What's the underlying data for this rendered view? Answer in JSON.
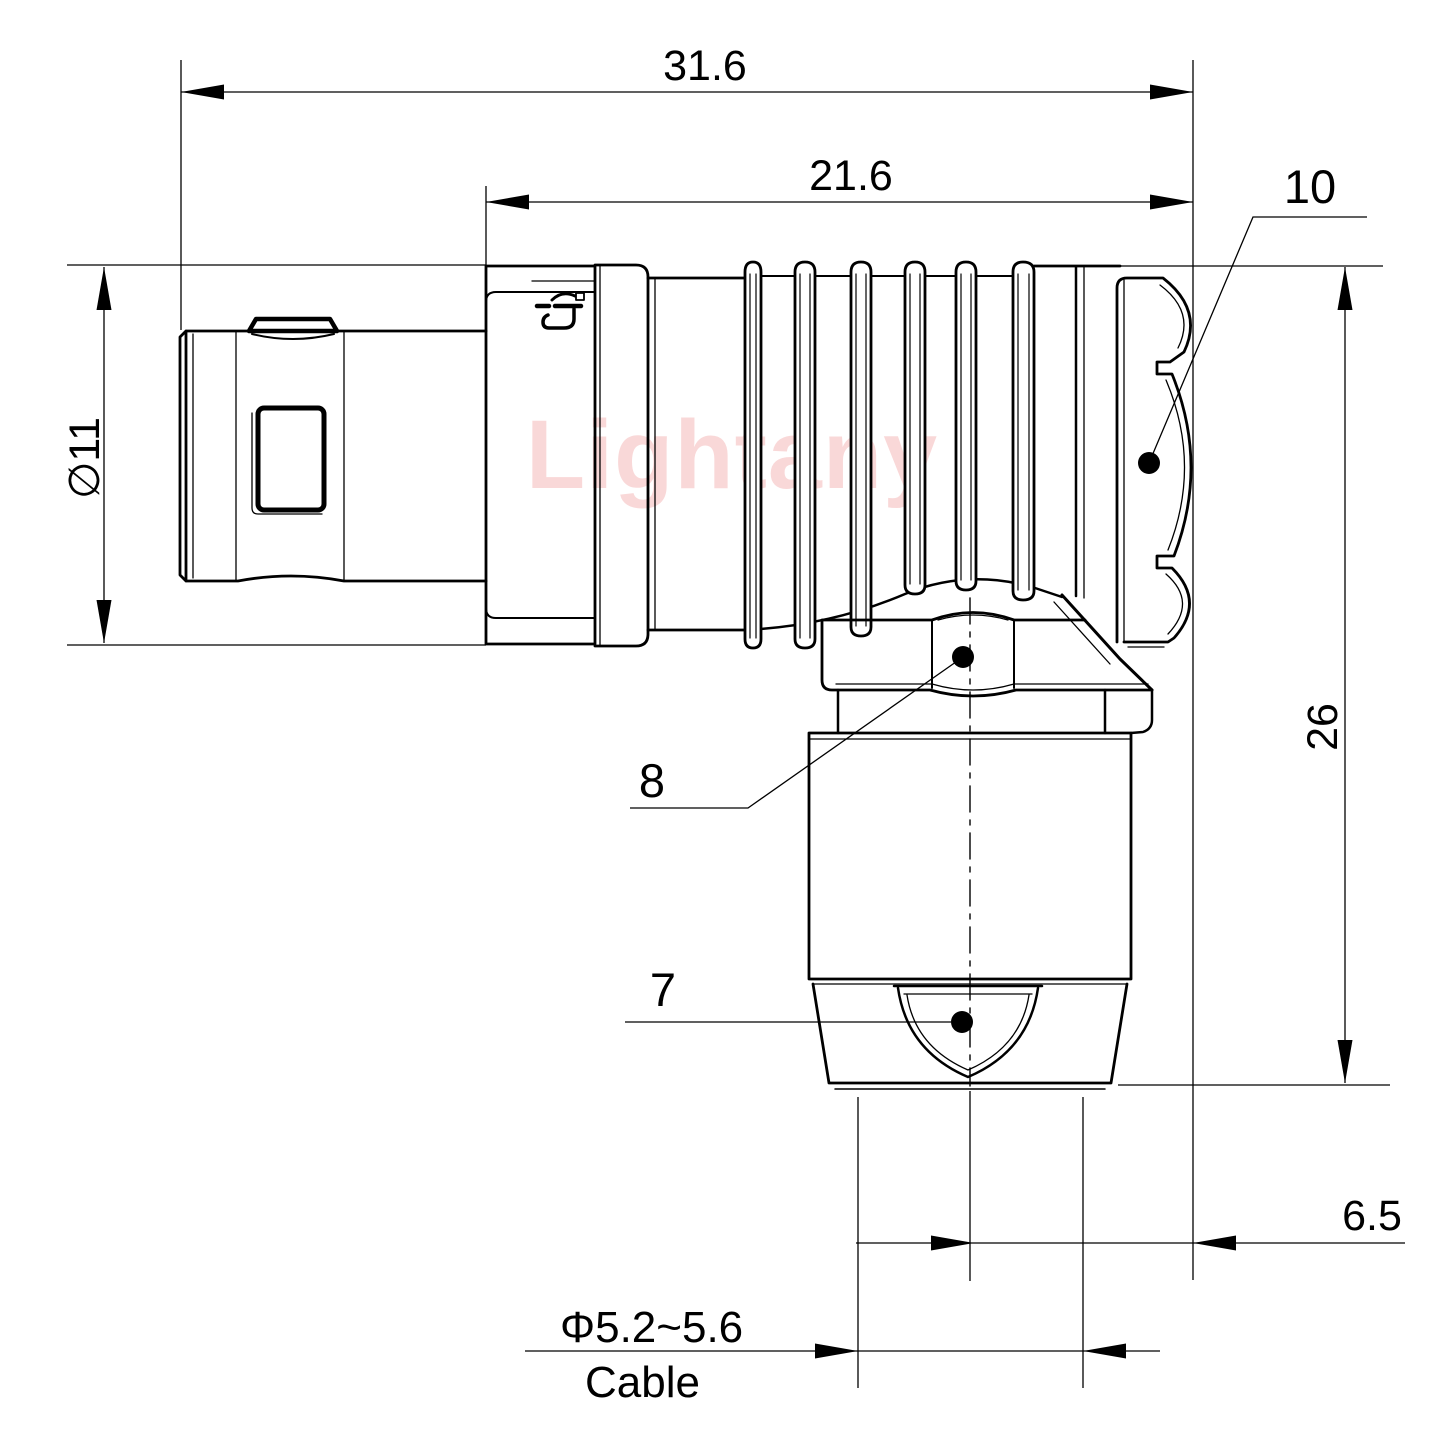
{
  "watermark": {
    "text": "Lightany",
    "color": "#ef8f8f"
  },
  "colors": {
    "line": "#000000",
    "background": "#ffffff"
  },
  "dimensions": {
    "overall_length": "31.6",
    "front_section_length": "21.6",
    "shell_diameter": "∅11",
    "overall_height": "26",
    "axis_to_face_offset": "6.5",
    "cable_diameter": "Φ5.2~5.6",
    "cable_caption": "Cable"
  },
  "callouts": {
    "coupling_nut": "10",
    "back_nut": "8",
    "cable_bushing": "7"
  }
}
